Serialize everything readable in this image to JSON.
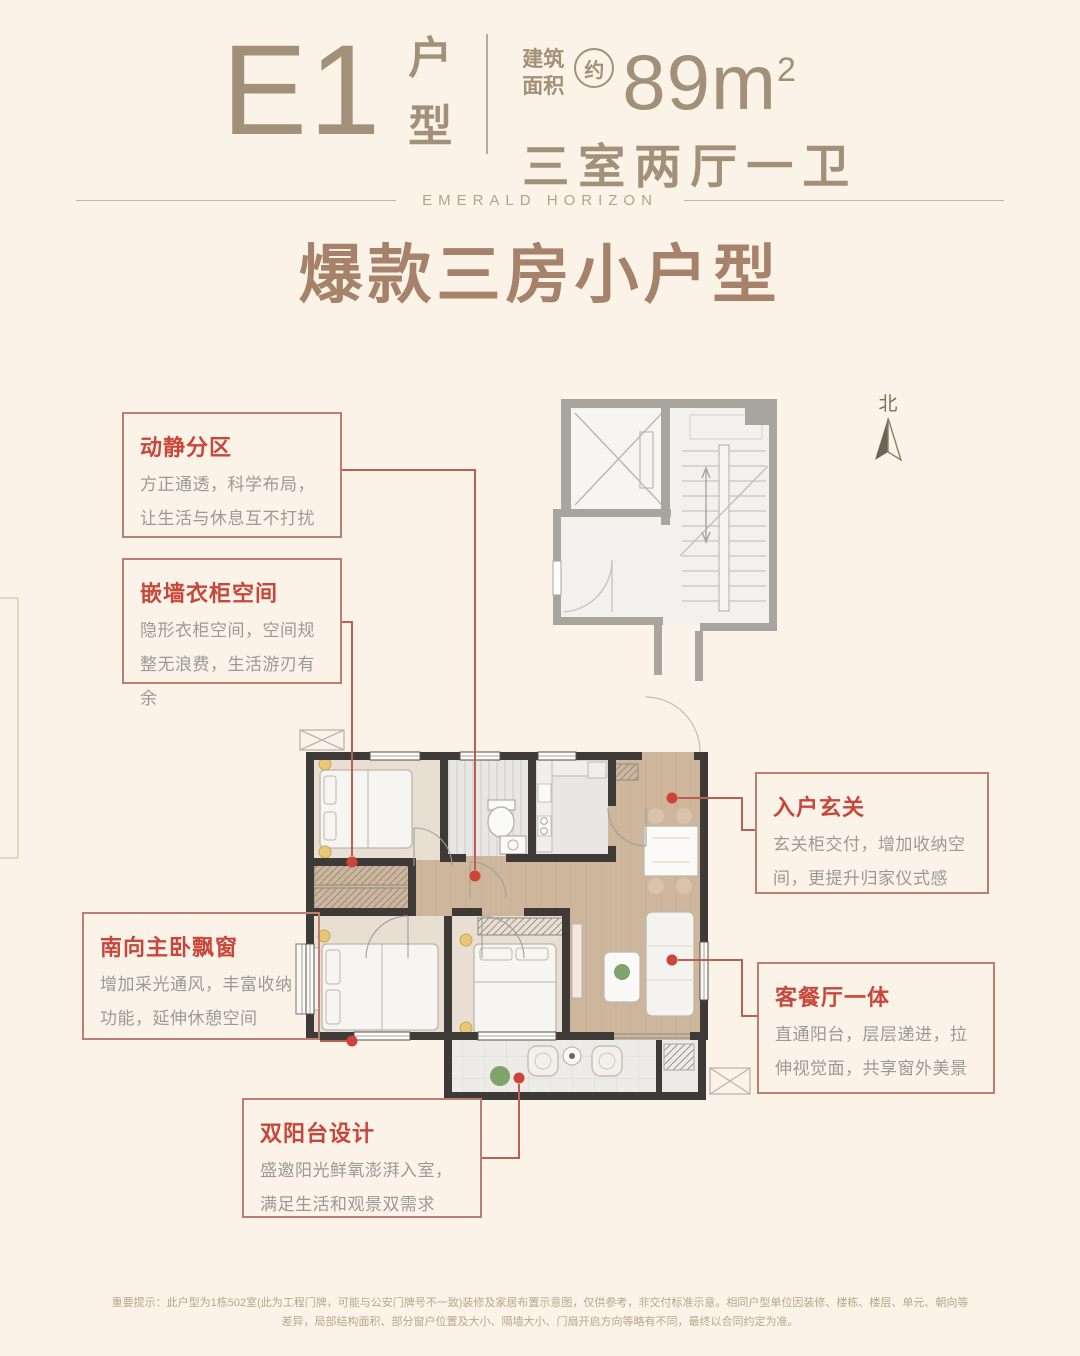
{
  "header": {
    "unit_code": "E1",
    "unit_type_label_1": "户",
    "unit_type_label_2": "型",
    "area_label_line1": "建筑",
    "area_label_line2": "面积",
    "approx_label": "约",
    "area_number": "89m",
    "area_exponent": "2",
    "rooms_text": "三室两厅一卫"
  },
  "brand_subtitle": "EMERALD HORIZON",
  "main_title": "爆款三房小户型",
  "north_label": "北",
  "callouts": [
    {
      "heading": "动静分区",
      "body": "方正通透，科学布局，让生活与休息互不打扰"
    },
    {
      "heading": "嵌墙衣柜空间",
      "body": "隐形衣柜空间，空间规整无浪费，生活游刃有余"
    },
    {
      "heading": "南向主卧飘窗",
      "body": "增加采光通风，丰富收纳功能，延伸休憩空间"
    },
    {
      "heading": "双阳台设计",
      "body": "盛邀阳光鲜氧澎湃入室，满足生活和观景双需求"
    },
    {
      "heading": "入户玄关",
      "body": "玄关柜交付，增加收纳空间，更提升归家仪式感"
    },
    {
      "heading": "客餐厅一体",
      "body": "直通阳台，层层递进，拉伸视觉面，共享窗外美景"
    }
  ],
  "disclaimer": "重要提示：此户型为1栋502室(此为工程门牌，可能与公安门牌号不一致)装修及家居布置示意图，仅供参考，非交付标准示意。相同户型单位因装修、楼栋、楼层、单元、朝向等差异，局部结构面积、部分窗户位置及大小、隔墙大小、门扇开启方向等略有不同，最终以合同约定为准。",
  "colors": {
    "background": "#fcf3e8",
    "accent_red": "#c8463a",
    "leader_red": "#bb5f50",
    "callout_border": "#bb7e70",
    "header_brown": "#a29078",
    "title_brown": "#a6826a",
    "body_gray": "#9c9994",
    "disclaimer_brown": "#b7a68f",
    "wall_dark": "#3d3a37",
    "wall_light": "#a8a49e",
    "wood_floor": "#cdb69b"
  }
}
